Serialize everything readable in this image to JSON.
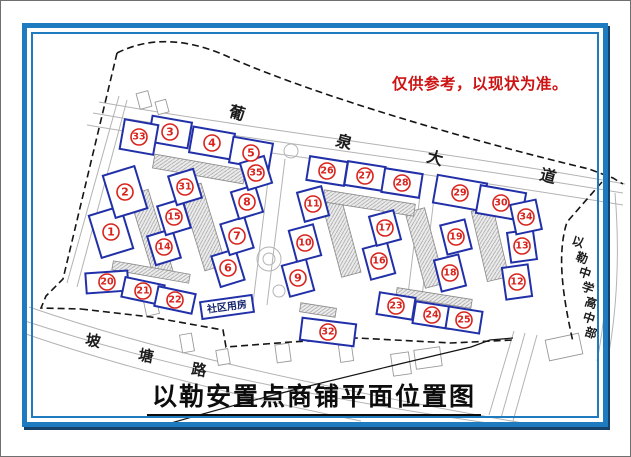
{
  "page": {
    "background": "#ffffff",
    "frame_color": "#1e7bbf"
  },
  "disclaimer": {
    "text": "仅供参考，以现状为准。",
    "color": "#cc1414"
  },
  "title": {
    "text": "以勒安置点商铺平面位置图"
  },
  "labels": {
    "community_room": {
      "text": "社区用房",
      "x": 226,
      "y": 306,
      "w": 52,
      "h": 17,
      "rotate": -8,
      "color": "#16246e"
    },
    "avenue": {
      "name": "葡泉大道",
      "chars": [
        {
          "ch": "葡",
          "x": 236,
          "y": 112
        },
        {
          "ch": "泉",
          "x": 343,
          "y": 141
        },
        {
          "ch": "大",
          "x": 434,
          "y": 157
        },
        {
          "ch": "道",
          "x": 547,
          "y": 175
        }
      ],
      "rotate": 15,
      "size": 16
    },
    "potang_road": {
      "name": "坡塘路",
      "chars": [
        {
          "ch": "坡",
          "x": 92,
          "y": 340
        },
        {
          "ch": "塘",
          "x": 145,
          "y": 355
        },
        {
          "ch": "路",
          "x": 198,
          "y": 369
        }
      ],
      "rotate": 10,
      "size": 15
    },
    "school": {
      "name": "以勒中学高中部",
      "chars": [
        {
          "ch": "以",
          "x": 577,
          "y": 241
        },
        {
          "ch": "勒",
          "x": 581,
          "y": 257
        },
        {
          "ch": "中",
          "x": 584,
          "y": 272
        },
        {
          "ch": "学",
          "x": 587,
          "y": 287
        },
        {
          "ch": "高",
          "x": 590,
          "y": 302
        },
        {
          "ch": "中",
          "x": 588,
          "y": 317
        },
        {
          "ch": "部",
          "x": 590,
          "y": 332
        }
      ],
      "rotate": 18,
      "size": 12
    }
  },
  "shops": [
    {
      "n": 1,
      "x": 110,
      "y": 231,
      "w": 33,
      "h": 44,
      "r": -17
    },
    {
      "n": 2,
      "x": 124,
      "y": 191,
      "w": 33,
      "h": 44,
      "r": -17
    },
    {
      "n": 3,
      "x": 169,
      "y": 131,
      "w": 40,
      "h": 26,
      "r": 10
    },
    {
      "n": 4,
      "x": 211,
      "y": 142,
      "w": 42,
      "h": 26,
      "r": 10
    },
    {
      "n": 5,
      "x": 250,
      "y": 152,
      "w": 40,
      "h": 26,
      "r": 10
    },
    {
      "n": 6,
      "x": 227,
      "y": 267,
      "w": 25,
      "h": 32,
      "r": -17
    },
    {
      "n": 7,
      "x": 236,
      "y": 235,
      "w": 25,
      "h": 32,
      "r": -17
    },
    {
      "n": 8,
      "x": 246,
      "y": 201,
      "w": 25,
      "h": 28,
      "r": -17
    },
    {
      "n": 9,
      "x": 297,
      "y": 277,
      "w": 25,
      "h": 32,
      "r": -15
    },
    {
      "n": 10,
      "x": 304,
      "y": 242,
      "w": 25,
      "h": 32,
      "r": -15
    },
    {
      "n": 11,
      "x": 312,
      "y": 203,
      "w": 25,
      "h": 30,
      "r": -15
    },
    {
      "n": 12,
      "x": 516,
      "y": 281,
      "w": 26,
      "h": 32,
      "r": -8
    },
    {
      "n": 13,
      "x": 521,
      "y": 245,
      "w": 26,
      "h": 30,
      "r": -8
    },
    {
      "n": 14,
      "x": 163,
      "y": 246,
      "w": 26,
      "h": 30,
      "r": -17
    },
    {
      "n": 15,
      "x": 173,
      "y": 216,
      "w": 26,
      "h": 30,
      "r": -17
    },
    {
      "n": 16,
      "x": 378,
      "y": 260,
      "w": 25,
      "h": 32,
      "r": -15
    },
    {
      "n": 17,
      "x": 384,
      "y": 227,
      "w": 25,
      "h": 30,
      "r": -15
    },
    {
      "n": 18,
      "x": 449,
      "y": 272,
      "w": 25,
      "h": 32,
      "r": -14
    },
    {
      "n": 19,
      "x": 455,
      "y": 236,
      "w": 25,
      "h": 30,
      "r": -14
    },
    {
      "n": 20,
      "x": 106,
      "y": 281,
      "w": 42,
      "h": 20,
      "r": -4
    },
    {
      "n": 21,
      "x": 142,
      "y": 290,
      "w": 40,
      "h": 20,
      "r": 12
    },
    {
      "n": 22,
      "x": 174,
      "y": 299,
      "w": 38,
      "h": 20,
      "r": 12
    },
    {
      "n": 23,
      "x": 395,
      "y": 305,
      "w": 36,
      "h": 22,
      "r": 9
    },
    {
      "n": 24,
      "x": 431,
      "y": 314,
      "w": 36,
      "h": 22,
      "r": 9
    },
    {
      "n": 25,
      "x": 463,
      "y": 319,
      "w": 34,
      "h": 22,
      "r": 9
    },
    {
      "n": 26,
      "x": 326,
      "y": 170,
      "w": 38,
      "h": 24,
      "r": 9
    },
    {
      "n": 27,
      "x": 364,
      "y": 175,
      "w": 38,
      "h": 24,
      "r": 9
    },
    {
      "n": 28,
      "x": 401,
      "y": 182,
      "w": 38,
      "h": 24,
      "r": 9
    },
    {
      "n": 29,
      "x": 459,
      "y": 192,
      "w": 50,
      "h": 28,
      "r": 10
    },
    {
      "n": 30,
      "x": 500,
      "y": 202,
      "w": 46,
      "h": 28,
      "r": 10
    },
    {
      "n": 31,
      "x": 184,
      "y": 186,
      "w": 26,
      "h": 30,
      "r": -17
    },
    {
      "n": 32,
      "x": 327,
      "y": 331,
      "w": 54,
      "h": 22,
      "r": 7
    },
    {
      "n": 33,
      "x": 138,
      "y": 136,
      "w": 34,
      "h": 30,
      "r": 10
    },
    {
      "n": 34,
      "x": 525,
      "y": 216,
      "w": 26,
      "h": 30,
      "r": -12
    },
    {
      "n": 35,
      "x": 255,
      "y": 172,
      "w": 25,
      "h": 28,
      "r": -17
    }
  ],
  "plan": {
    "colors": {
      "parcel": "#2130a8",
      "marker": "#d8231c",
      "road": "#b3b3b3",
      "boundary": "#151515",
      "building_stroke": "#8a8a8a",
      "structure_stroke": "#9a9a9a"
    },
    "road_paths": [
      "M92,112 C240,138 430,160 622,192",
      "M86,124 C240,150 430,172 622,204",
      "M98,101 C250,128 440,150 624,183",
      "M118,95 L66,282",
      "M126,99 L76,286",
      "M270,155 L252,302",
      "M284,158 L266,304",
      "M420,186 L404,318",
      "M434,189 L418,320",
      "M28,306 C150,348 300,384 556,428",
      "M24,320 C140,358 280,392 500,424",
      "M22,332 C120,366 230,394 360,420",
      "M513,330 L488,414",
      "M524,332 L500,417",
      "M536,334 L512,420",
      "M604,190 C609,250 606,310 596,360",
      "M614,192 C619,252 616,312 606,362"
    ],
    "boundary_dashed_paths": [
      "M116,52 C148,36 186,36 232,58 C320,96 470,140 588,168 L612,177 L622,183",
      "M116,52 L62,278 L45,295 L40,307 L80,308",
      "M80,308 L150,316 L222,329 L225,346 L290,341 L356,337 L450,342 L512,339",
      "M601,181 L566,221 C556,252 561,292 572,341"
    ],
    "boundary_solid_paths": [
      "M150,428 C250,398 360,372 470,346 L489,339 L512,337"
    ],
    "buildings": [
      {
        "x": 150,
        "y": 232,
        "w": 20,
        "h": 85,
        "r": -17
      },
      {
        "x": 202,
        "y": 226,
        "w": 22,
        "h": 85,
        "r": -17
      },
      {
        "x": 198,
        "y": 168,
        "w": 92,
        "h": 14,
        "r": 10
      },
      {
        "x": 340,
        "y": 235,
        "w": 20,
        "h": 80,
        "r": -15
      },
      {
        "x": 424,
        "y": 247,
        "w": 20,
        "h": 78,
        "r": -15
      },
      {
        "x": 368,
        "y": 202,
        "w": 92,
        "h": 12,
        "r": 9
      },
      {
        "x": 489,
        "y": 243,
        "w": 22,
        "h": 72,
        "r": -13
      },
      {
        "x": 150,
        "y": 271,
        "w": 78,
        "h": 9,
        "r": 10
      },
      {
        "x": 433,
        "y": 297,
        "w": 76,
        "h": 9,
        "r": 9
      },
      {
        "x": 317,
        "y": 309,
        "w": 36,
        "h": 9,
        "r": 9
      }
    ],
    "roundabouts": [
      {
        "x": 268,
        "y": 258,
        "radius": 12
      },
      {
        "x": 268,
        "y": 258,
        "radius": 6
      },
      {
        "x": 278,
        "y": 290,
        "radius": 6
      },
      {
        "x": 290,
        "y": 150,
        "radius": 7
      }
    ],
    "small_structures": [
      {
        "x": 143,
        "y": 99,
        "w": 12,
        "h": 16,
        "r": -15
      },
      {
        "x": 161,
        "y": 106,
        "w": 11,
        "h": 13,
        "r": -15
      },
      {
        "x": 150,
        "y": 304,
        "w": 13,
        "h": 20,
        "r": -12
      },
      {
        "x": 186,
        "y": 342,
        "w": 12,
        "h": 18,
        "r": -10
      },
      {
        "x": 222,
        "y": 356,
        "w": 12,
        "h": 15,
        "r": -10
      },
      {
        "x": 282,
        "y": 352,
        "w": 14,
        "h": 18,
        "r": -8
      },
      {
        "x": 345,
        "y": 352,
        "w": 13,
        "h": 17,
        "r": -8
      },
      {
        "x": 400,
        "y": 363,
        "w": 18,
        "h": 22,
        "r": -8
      },
      {
        "x": 427,
        "y": 357,
        "w": 26,
        "h": 19,
        "r": -8
      },
      {
        "x": 563,
        "y": 346,
        "w": 34,
        "h": 21,
        "r": -12
      }
    ]
  }
}
